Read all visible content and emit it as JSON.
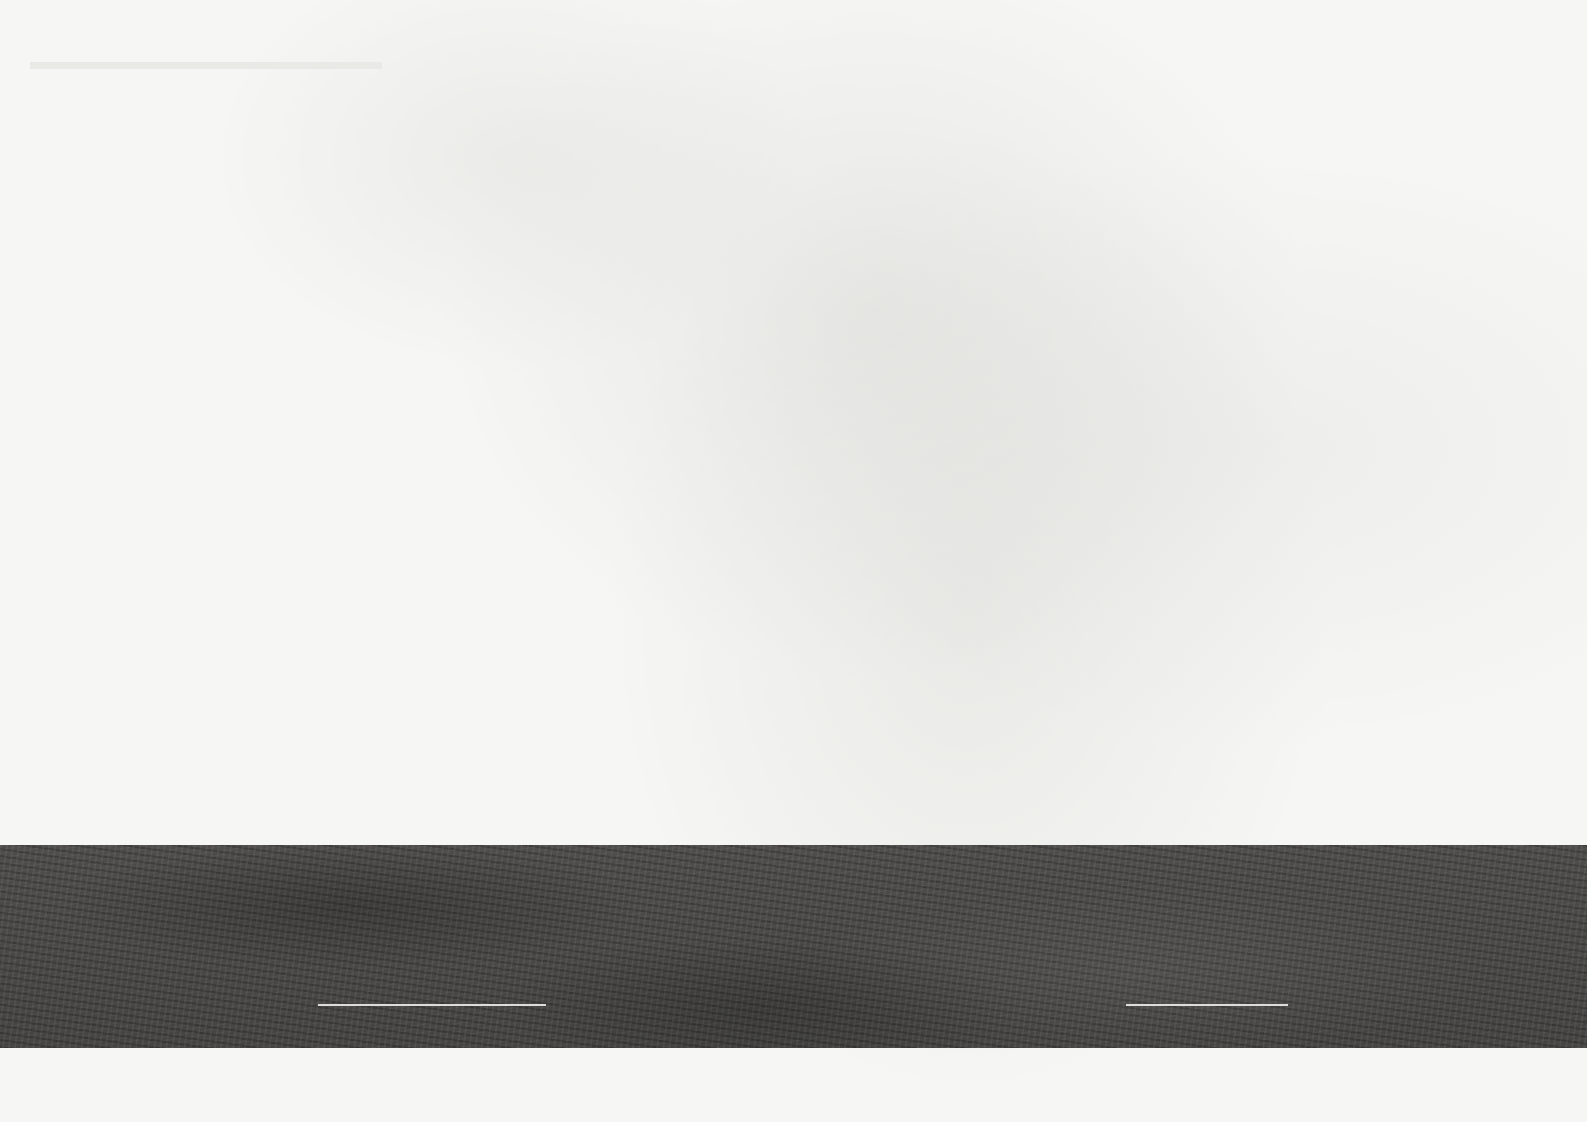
{
  "page_title": {
    "zh": "技术图纸",
    "en": "Technical Drawings"
  },
  "drawings": [
    {
      "name": "A-A section",
      "title_zh": "A-A剖面图",
      "scale": "1:500",
      "elevations": [
        "88.250",
        "84.050",
        "81.050",
        "78.050",
        "75.050",
        "72.050",
        "69.050",
        "66.050",
        "63.050",
        "60.050",
        "57.050",
        "54.050",
        "51.050",
        "48.050",
        "45.050",
        "42.050",
        "39.050",
        "36.050",
        "33.050",
        "30.050",
        "24.650",
        "20.450",
        "16.450",
        "12.650",
        "8.050",
        "4.200",
        "±0.000",
        "-4.200",
        "-8.400"
      ],
      "grid": {
        "bubbles": [
          "1",
          "2",
          "3",
          "4",
          "5",
          "6",
          "7",
          "8",
          "9",
          "10",
          "11"
        ],
        "spans_mm": [
          "4200",
          "8400",
          "8400",
          "7200",
          "7200",
          "8400",
          "8400",
          "8400",
          "8300",
          "7200"
        ],
        "total_mm": "76100"
      }
    },
    {
      "name": "B-B section",
      "title_zh": "B-B剖面图",
      "scale": "1:500",
      "elevations": [
        "88.250",
        "84.050",
        "81.050",
        "78.050",
        "75.050",
        "72.050",
        "69.050",
        "66.050",
        "63.050",
        "60.050",
        "57.050",
        "54.050",
        "51.050",
        "48.050",
        "45.050",
        "42.050",
        "39.050",
        "36.050",
        "33.050",
        "30.050",
        "24.650",
        "20.450",
        "16.450",
        "12.650",
        "8.050",
        "4.200",
        "±0.000",
        "-4.200",
        "-8.400"
      ],
      "grid": {
        "bubbles": [
          "1",
          "2",
          "3",
          "4",
          "5",
          "6",
          "7",
          "8",
          "9",
          "10",
          "11",
          "12"
        ],
        "spans_mm": [
          "7200",
          "8400",
          "8400",
          "7200",
          "7200",
          "8400",
          "8400",
          "8400",
          "8400",
          "8400",
          "7200"
        ],
        "total_mm": "87600"
      }
    }
  ],
  "footer": {
    "project_zh": "山东信通院研发中心方案设计",
    "project_en_line1": "Design of Research and Development Center of",
    "project_en_line2": "Jinan Information and Communication Institute"
  },
  "colors": {
    "floor_purple": "#b1b0ca",
    "floor_blue": "#c2d2e8",
    "floor_yellow": "#f4eed2",
    "ground_band": "#4a4947",
    "tree_green": "#aac39a"
  }
}
